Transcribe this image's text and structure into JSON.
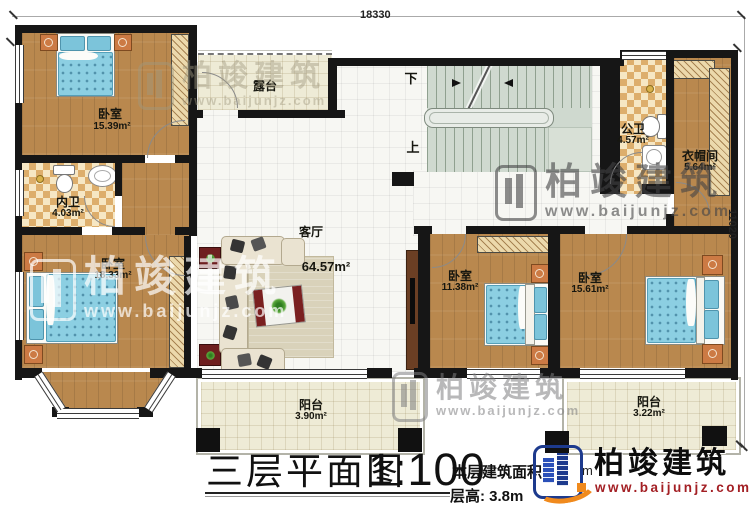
{
  "plan": {
    "rooms": [
      {
        "id": "bedroom-top-left",
        "name": "卧室",
        "area": "15.39m²"
      },
      {
        "id": "inner-bath",
        "name": "内卫",
        "area": "4.03m²"
      },
      {
        "id": "bedroom-bottom-left",
        "name": "卧室",
        "area": "18.33m²"
      },
      {
        "id": "terrace",
        "name": "露台",
        "area": ""
      },
      {
        "id": "living-room",
        "name": "客厅",
        "area": "64.57m²"
      },
      {
        "id": "public-bath",
        "name": "公卫",
        "area": "4.57m²"
      },
      {
        "id": "cloakroom",
        "name": "衣帽间",
        "area": "5.64m²"
      },
      {
        "id": "bedroom-middle",
        "name": "卧室",
        "area": "11.38m²"
      },
      {
        "id": "bedroom-right",
        "name": "卧室",
        "area": "15.61m²"
      },
      {
        "id": "balcony-center",
        "name": "阳台",
        "area": "3.90m²"
      },
      {
        "id": "balcony-right",
        "name": "阳台",
        "area": "3.22m²"
      }
    ],
    "stairs": {
      "down": "下",
      "up": "上"
    },
    "dimensions": {
      "top": "18330",
      "right": "11020"
    }
  },
  "title_block": {
    "title": "三层平面图",
    "scale": "1:100",
    "area_label": "本层建筑面积:",
    "area_value_partial": "m",
    "floor_height": "层高: 3.8m"
  },
  "brand": {
    "name": "柏竣建筑",
    "website": "www.baijunjz.com"
  },
  "watermark": {
    "name": "柏竣建筑",
    "website": "www.baijunjz.com"
  }
}
